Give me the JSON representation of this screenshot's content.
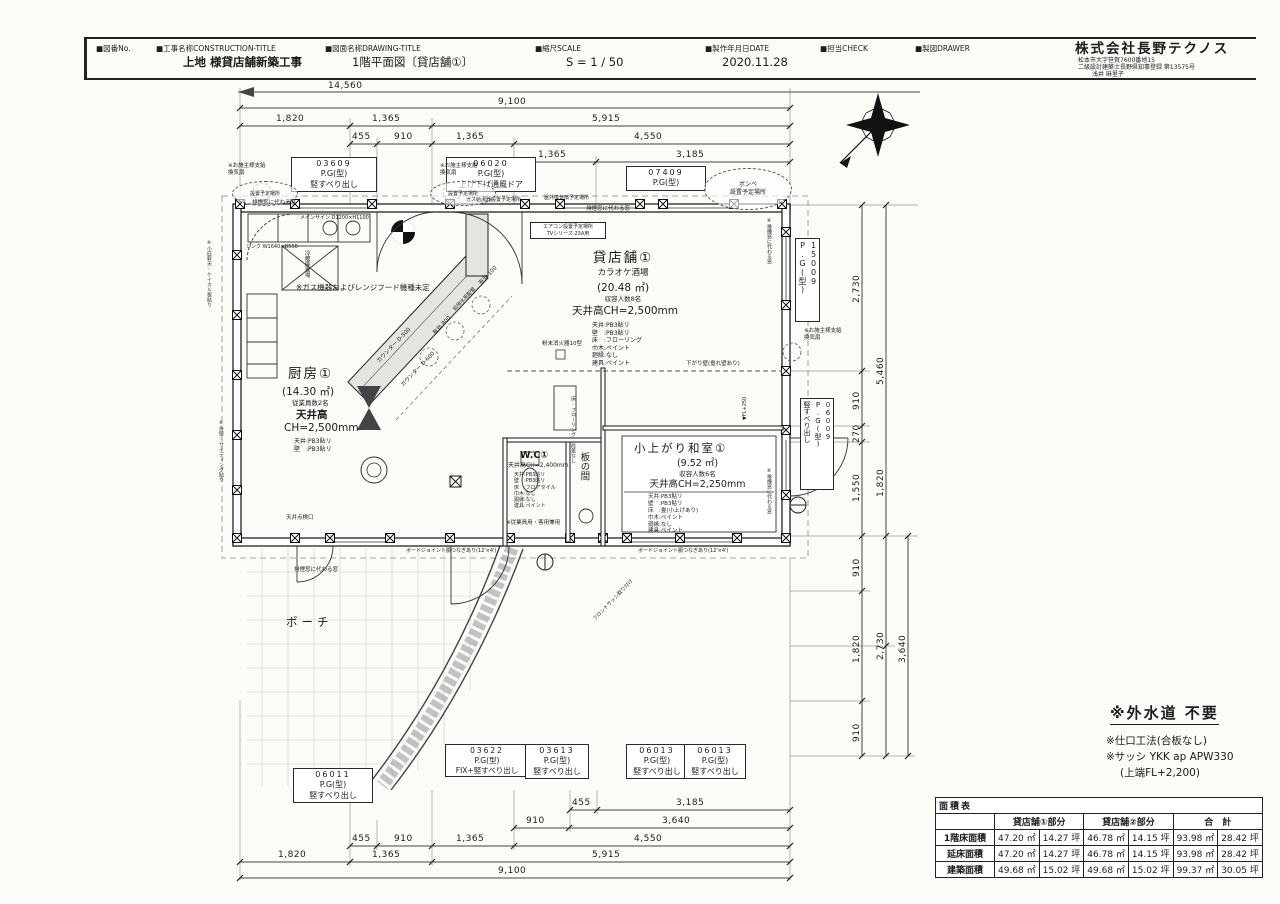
{
  "title_block": {
    "fields": [
      {
        "label": "■図番No.",
        "value": ""
      },
      {
        "label": "■工事名称CONSTRUCTION-TITLE",
        "value": "上地  様貸店舗新築工事"
      },
      {
        "label": "■図面名称DRAWING-TITLE",
        "value": "1階平面図〔貸店舗①〕"
      },
      {
        "label": "■縮尺SCALE",
        "value": "S = 1 / 50"
      },
      {
        "label": "■製作年月日DATE",
        "value": "2020.11.28"
      },
      {
        "label": "■担当CHECK",
        "value": ""
      },
      {
        "label": "■製図DRAWER",
        "value": ""
      }
    ],
    "company": {
      "name": "株式会社長野テクノス",
      "address": "松本市大字笹賀7600番地15",
      "license": "二級設計建築士長野県知事登録  第13575号",
      "drafter": "浅井  麻里子"
    }
  },
  "dims": {
    "top": {
      "t1": "14,560",
      "t2": "9,100",
      "r3": [
        "1,820",
        "1,365",
        "5,915"
      ],
      "r4": [
        "455",
        "910",
        "1,365",
        "4,550"
      ],
      "r5": [
        "1,365",
        "3,185"
      ]
    },
    "bottom": {
      "r1": [
        "455",
        "3,185"
      ],
      "r2": [
        "910",
        "3,640"
      ],
      "r3": [
        "455",
        "910",
        "1,365",
        "4,550"
      ],
      "r4": [
        "1,820",
        "1,365",
        "5,915"
      ],
      "total": "9,100"
    },
    "right": {
      "a": [
        "2,730",
        "910",
        "270",
        "1,550",
        "910",
        "1,820",
        "910"
      ],
      "b": [
        "5,460",
        "1,820",
        "2,730"
      ],
      "c": [
        "3,640"
      ]
    }
  },
  "windows": {
    "w03609": {
      "code": "03609",
      "type": "P.G(型)",
      "op": "竪すべり出し"
    },
    "w06020": {
      "code": "06020",
      "type": "P.G(型)",
      "op": "上げ下げ通風ドア"
    },
    "w07409": {
      "code": "07409",
      "type": "P.G(型)"
    },
    "w15009": {
      "code": "15009",
      "type": "P.G(型)"
    },
    "w06009": {
      "code": "06009",
      "type": "P.G(型)",
      "op": "竪すべり出し"
    },
    "w06011": {
      "code": "06011",
      "type": "P.G(型)",
      "op": "竪すべり出し"
    },
    "w03622": {
      "code": "03622",
      "type": "P.G(型)",
      "op": "FIX+竪すべり出し"
    },
    "w03613": {
      "code": "03613",
      "type": "P.G(型)",
      "op": "竪すべり出し"
    },
    "w06013a": {
      "code": "06013",
      "type": "P.G(型)",
      "op": "竪すべり出し"
    },
    "w06013b": {
      "code": "06013",
      "type": "P.G(型)",
      "op": "竪すべり出し"
    }
  },
  "rooms": {
    "tenant": {
      "name": "貸店舗①",
      "use": "カラオケ酒場",
      "area": "(20.48 ㎡)",
      "cap": "収容人数8名",
      "ch": "天井高CH=2,500mm",
      "spec": "天井:PB3貼リ\n壁　:PB3貼リ\n床　:フローリング\n巾木:ペイント\n廻縁:なし\n建具:ペイント"
    },
    "kitchen": {
      "name": "厨房①",
      "area": "(14.30 ㎡)",
      "cap": "従業員数2名",
      "ch1": "天井高",
      "ch2": "CH=2,500mm",
      "spec": "天井:PB3貼リ\n壁　:PB3貼リ"
    },
    "washitsu": {
      "name": "小上がり和室①",
      "area": "(9.52 ㎡)",
      "cap": "収容人数6名",
      "ch": "天井高CH=2,250mm",
      "spec": "天井:PB3貼リ\n壁　:PB3貼リ\n床　:畳(小上げあり)\n巾木:ペイント\n廻縁:なし\n建具:ペイント"
    },
    "wc": {
      "name": "W.C①",
      "ch": "天井高CH=2,400mm",
      "spec": "天井:PB3貼リ\n壁　:PB3貼リ\n床　:フロアタイル\n巾木:なし\n廻縁:なし\n建具:ペイント"
    },
    "itanoma": {
      "name": "板の間"
    },
    "porch": {
      "name": "ポーチ"
    }
  },
  "ann": {
    "owner_fan": "※お施主様支給\n換気扇",
    "install": "設置予定場所",
    "smoke_window": "排煙窓に代わる窓",
    "smoke_window_v": "※排煙窓に代わる窓",
    "gas_water": "ガス給湯器設置予定場所",
    "out_fan": "屋外換気扇予定場所",
    "bonbe": "ボンベ\n設置予定場所",
    "aircon": "エアコン設置予定場所\nTVシリーズ 23A用",
    "main_sign": "メインサイン D1200×H1100",
    "gas_unknown": "※ガス機器およびレンジフード機種未定",
    "sink": "シンク W1640×D550",
    "fridge": "冷蔵庫置場",
    "counter_a": "カウンター D-500",
    "counter_b": "カウンター D-600",
    "eff800": "有効 800",
    "eff100": "有効 100",
    "pipe": "給排水用配管",
    "fire": "粉末消火器10型",
    "sagari": "下がり壁(垂れ壁あり)",
    "fl250": "▼FL+250",
    "tenken": "天井点検口",
    "front_sash": "フロントサッシ取り付け",
    "board_joint": "ボードジョイント胴つなぎあり(12'×4')",
    "left_note1": "※小庇軒天:ケイカル板貼り",
    "left_note2": "※外壁:サイディング貼り",
    "wc_use": "※従業員用・客用兼用",
    "itanoma_note": "床:フローリング 段差なし"
  },
  "notes": {
    "main": "※外水道  不要",
    "sub1": "※仕口工法(合板なし)",
    "sub2": "※サッシ YKK ap APW330",
    "sub3": "(上端FL+2,200)"
  },
  "area_table": {
    "title": "面積表",
    "headers": [
      "貸店舗①部分",
      "貸店舗②部分",
      "合　計"
    ],
    "rows": [
      {
        "label": "1階床面積",
        "cells": [
          "47.20 ㎡",
          "14.27 坪",
          "46.78 ㎡",
          "14.15 坪",
          "93.98 ㎡",
          "28.42 坪"
        ]
      },
      {
        "label": "延床面積",
        "cells": [
          "47.20 ㎡",
          "14.27 坪",
          "46.78 ㎡",
          "14.15 坪",
          "93.98 ㎡",
          "28.42 坪"
        ]
      },
      {
        "label": "建築面積",
        "cells": [
          "49.68 ㎡",
          "15.02 坪",
          "49.68 ㎡",
          "15.02 坪",
          "99.37 ㎡",
          "30.05 坪"
        ]
      }
    ]
  }
}
